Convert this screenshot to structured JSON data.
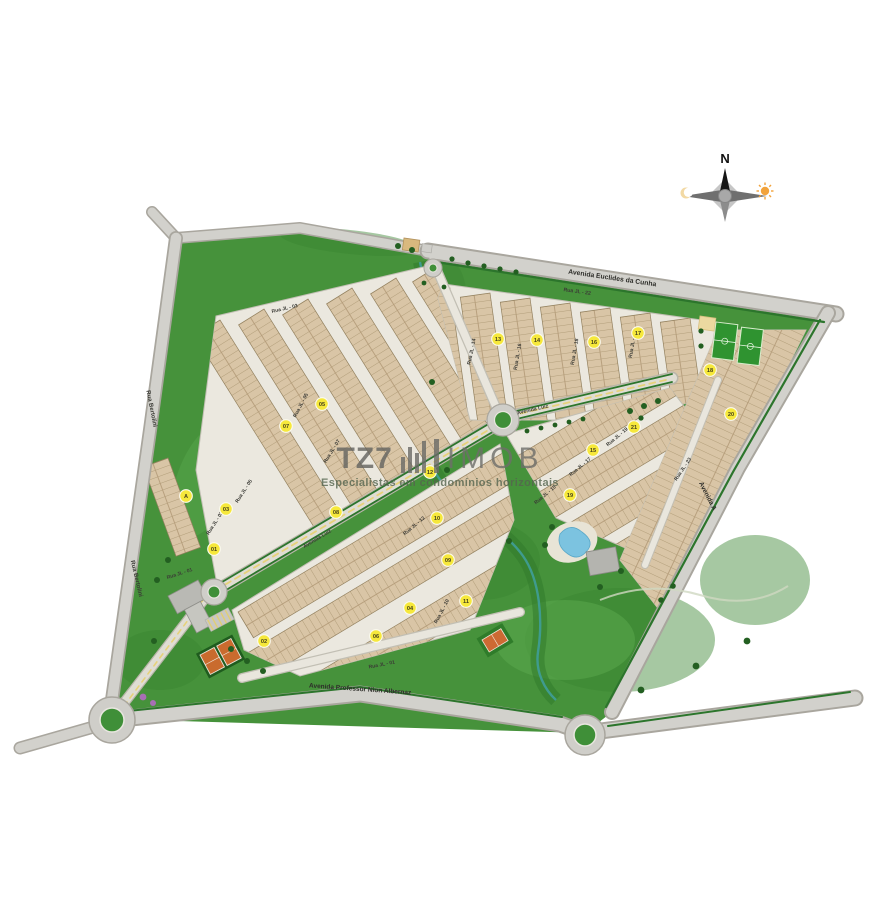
{
  "page": {
    "background": "#ffffff"
  },
  "compass": {
    "north_label": "N"
  },
  "watermark": {
    "brand_left": "TZ7",
    "brand_right": "IMOB",
    "tagline": "Especialistas em condomínios horizontais"
  },
  "streets": {
    "euclides": "Avenida Euclides da Cunha",
    "nion": "Avenida Professor Nion Albernaz",
    "avenida_a": "Avenida A",
    "bertolini_1": "Rua Bertolini",
    "bertolini_2": "Rua Bertolini",
    "luiz_1": "Avenida Luiz",
    "luiz_2": "Avenida Luiz",
    "jl01_a": "Rua JL - 01",
    "jl01_b": "Rua JL - 01",
    "jl03_a": "Rua JL - 03",
    "jl03_b": "Rua JL - 03",
    "jl05_a": "Rua JL - 05",
    "jl05_b": "Rua JL - 05",
    "jl07": "Rua JL - 07",
    "jl10": "Rua JL - 10",
    "jl12": "Rua JL - 12",
    "jl14": "Rua JL - 14",
    "jl16": "Rua JL - 16",
    "jl18": "Rua JL - 18",
    "jl20": "Rua JL - 20",
    "jl15": "Rua JL - 15",
    "jl17": "Rua JL - 17",
    "jl19": "Rua JL - 19",
    "jl22": "Rua JL - 22",
    "jl23": "Rua JL - 23"
  },
  "badges": [
    {
      "label": "A"
    },
    {
      "label": "01"
    },
    {
      "label": "02"
    },
    {
      "label": "03"
    },
    {
      "label": "04"
    },
    {
      "label": "05"
    },
    {
      "label": "06"
    },
    {
      "label": "07"
    },
    {
      "label": "08"
    },
    {
      "label": "09"
    },
    {
      "label": "10"
    },
    {
      "label": "11"
    },
    {
      "label": "12"
    },
    {
      "label": "13"
    },
    {
      "label": "14"
    },
    {
      "label": "15"
    },
    {
      "label": "16"
    },
    {
      "label": "17"
    },
    {
      "label": "18"
    },
    {
      "label": "19"
    },
    {
      "label": "20"
    },
    {
      "label": "21"
    }
  ],
  "colors": {
    "site_green": "#46923b",
    "road_gray": "#d2d1cc",
    "lot_tan": "#d9c5a6",
    "badge_yellow": "#f6e83b",
    "pool_blue": "#7cc3e0",
    "court_orange": "#cd6a33",
    "field_green": "#2f9330"
  }
}
